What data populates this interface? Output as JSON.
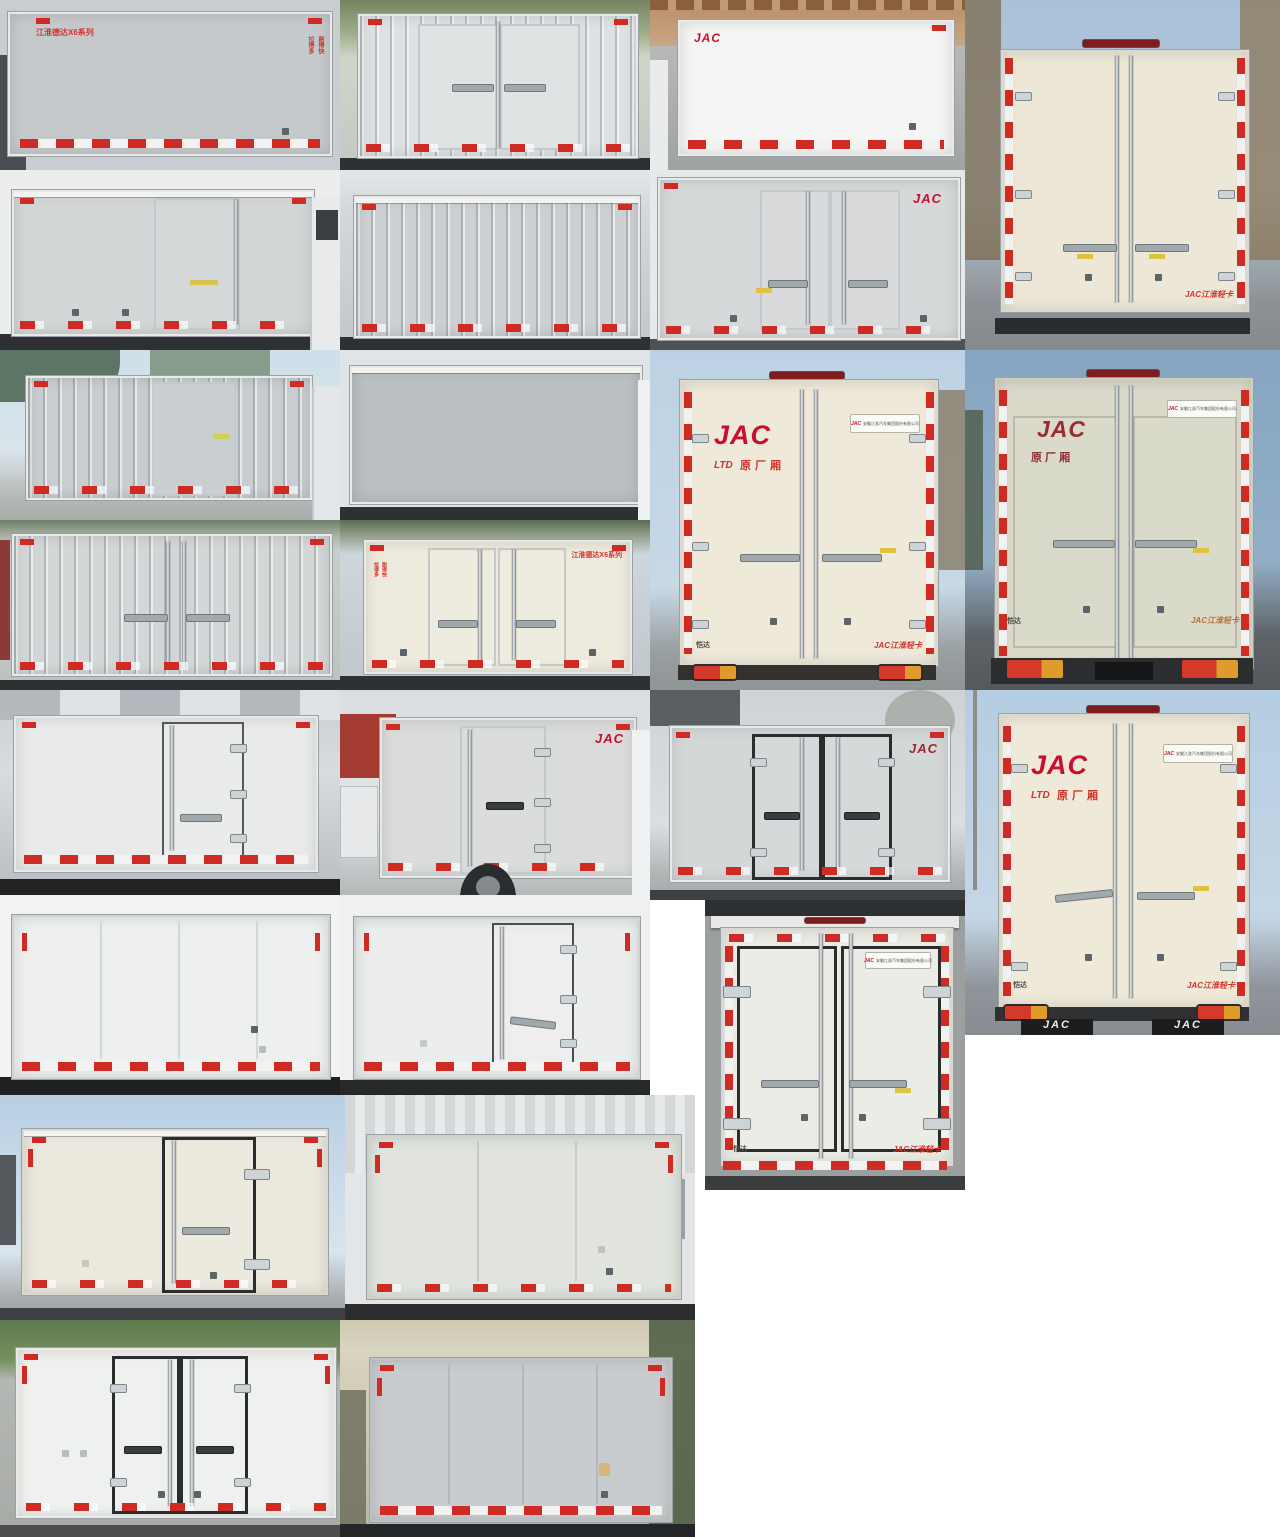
{
  "page": {
    "title": "JAC 厢式货车车厢照片拼图",
    "background": "#ffffff",
    "grid": "8 rows, 24 photos"
  },
  "colors": {
    "jac_red": "#c8102e",
    "reflect_red": "#cf2a24",
    "box_cream": "#ece7d6",
    "box_gray": "#ccd0d2",
    "sky": "#b5cde2"
  },
  "labels": {
    "jac": "JAC",
    "model_series": "江淮德达X6系列",
    "slogan_a": "拉得多",
    "slogan_b": "跑得快",
    "oem_mark": "LTD",
    "oem_box": "原厂厢",
    "oem_box_spaced": "原 厂 厢",
    "plate_company": "安徽江淮汽车集团股份有限公司",
    "model_kaida": "恺达",
    "jac_light_truck": "JAC江淮轻卡"
  },
  "photos": [
    {
      "n": 1,
      "view": "side",
      "body": "gray",
      "texts": [
        "江淮德达X6系列",
        "拉得多 跑得快"
      ]
    },
    {
      "n": 2,
      "view": "rear-side",
      "body": "white-corrugated",
      "texts": []
    },
    {
      "n": 3,
      "view": "side",
      "body": "white",
      "texts": [
        "JAC"
      ]
    },
    {
      "n": 4,
      "view": "rear",
      "body": "cream",
      "texts": [
        "JAC江淮轻卡"
      ]
    },
    {
      "n": 5,
      "view": "side-door",
      "body": "gray",
      "texts": []
    },
    {
      "n": 6,
      "view": "side",
      "body": "gray-corrugated",
      "texts": []
    },
    {
      "n": 7,
      "view": "side-doors",
      "body": "gray",
      "texts": [
        "JAC"
      ]
    },
    {
      "n": 8,
      "view": "side-door",
      "body": "gray-corrugated",
      "texts": []
    },
    {
      "n": 9,
      "view": "side",
      "body": "gray",
      "texts": []
    },
    {
      "n": 10,
      "view": "rear",
      "body": "cream",
      "texts": [
        "JAC",
        "LTD 原厂厢",
        "安徽江淮汽车集团股份有限公司",
        "恺达",
        "JAC江淮轻卡"
      ]
    },
    {
      "n": 11,
      "view": "rear",
      "body": "beige-corrugated",
      "texts": [
        "JAC",
        "原 厂 厢",
        "安徽江淮汽车集团股份有限公司",
        "恺达",
        "JAC江淮轻卡"
      ]
    },
    {
      "n": 12,
      "view": "side-doors",
      "body": "gray-corrugated",
      "texts": []
    },
    {
      "n": 13,
      "view": "side-doors",
      "body": "cream",
      "texts": [
        "江淮德达X6系列",
        "拉得多 跑得快"
      ]
    },
    {
      "n": 14,
      "view": "side-door",
      "body": "white",
      "texts": []
    },
    {
      "n": 15,
      "view": "side-door",
      "body": "gray",
      "texts": [
        "JAC"
      ]
    },
    {
      "n": 16,
      "view": "side-doors",
      "body": "gray",
      "texts": [
        "JAC"
      ]
    },
    {
      "n": 17,
      "view": "rear",
      "body": "cream",
      "texts": [
        "JAC",
        "LTD 原厂厢",
        "安徽江淮汽车集团股份有限公司",
        "恺达",
        "JAC江淮轻卡",
        "JAC"
      ]
    },
    {
      "n": 18,
      "view": "side",
      "body": "white",
      "texts": []
    },
    {
      "n": 19,
      "view": "side-door",
      "body": "white",
      "texts": []
    },
    {
      "n": 20,
      "view": "rear",
      "body": "white",
      "texts": [
        "安徽江淮汽车集团股份有限公司",
        "恺达",
        "JAC江淮轻卡"
      ]
    },
    {
      "n": 21,
      "view": "side-door",
      "body": "cream",
      "texts": []
    },
    {
      "n": 22,
      "view": "side",
      "body": "pale-green",
      "texts": []
    },
    {
      "n": 23,
      "view": "side-doors",
      "body": "white",
      "texts": []
    },
    {
      "n": 24,
      "view": "side",
      "body": "gray",
      "texts": []
    }
  ]
}
